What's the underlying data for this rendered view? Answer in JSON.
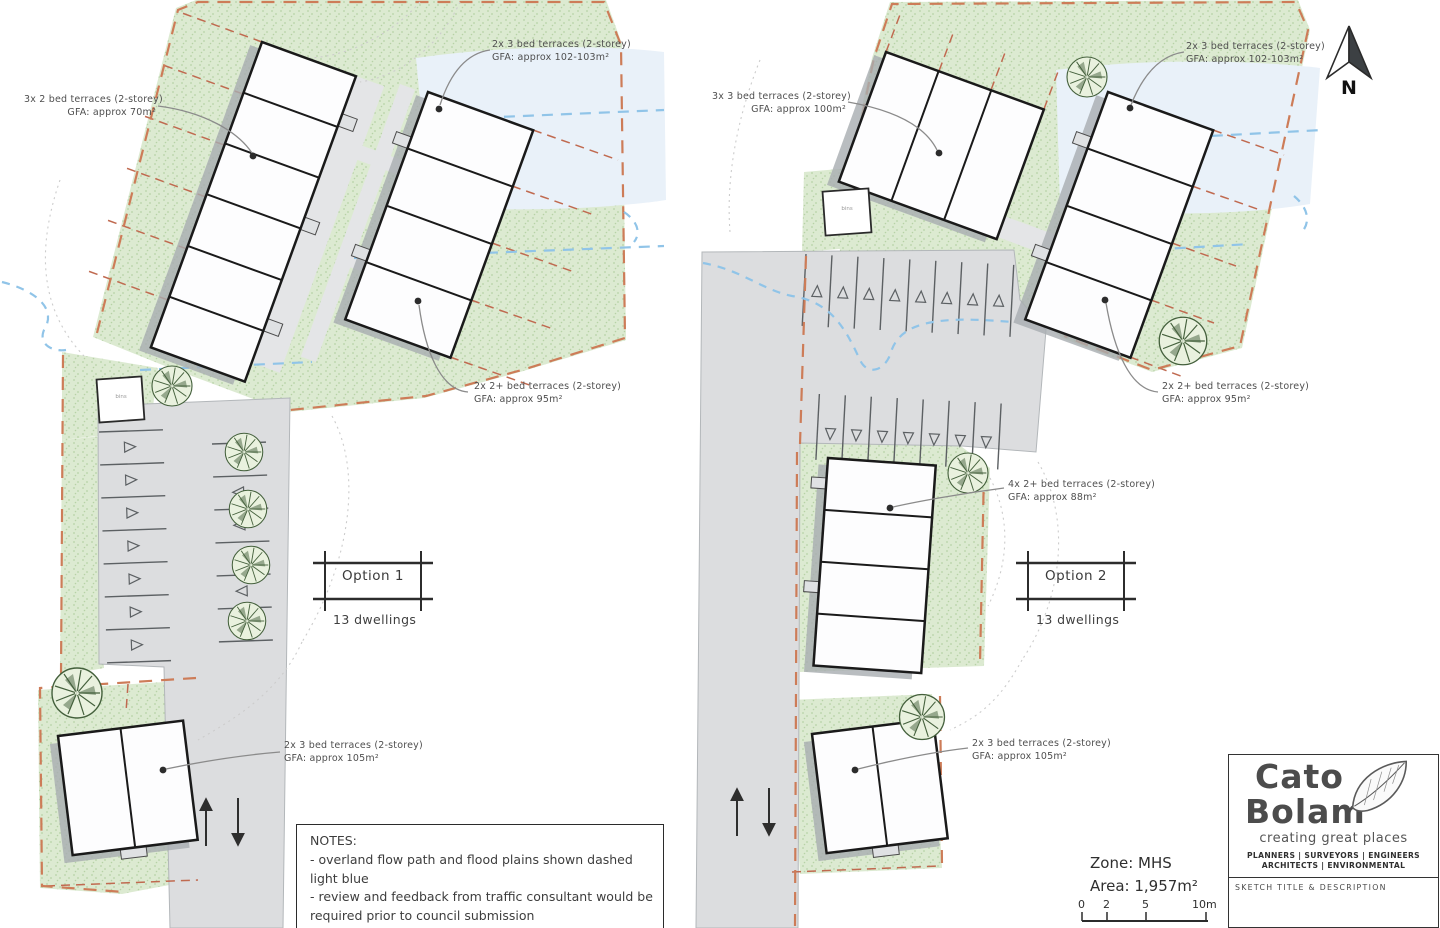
{
  "north_label": "N",
  "plans": {
    "option1": {
      "title": "Option 1",
      "dwellings": "13 dwellings",
      "bin_label": "bins",
      "annotations": [
        {
          "line1": "3x 2 bed terraces  (2-storey)",
          "line2": "GFA: approx 70m²"
        },
        {
          "line1": "2x 3 bed terraces  (2-storey)",
          "line2": "GFA: approx 102-103m²"
        },
        {
          "line1": "2x 2+ bed terraces  (2-storey)",
          "line2": "GFA: approx 95m²"
        },
        {
          "line1": "2x 3 bed terraces  (2-storey)",
          "line2": "GFA: approx 105m²"
        }
      ]
    },
    "option2": {
      "title": "Option 2",
      "dwellings": "13 dwellings",
      "bin_label": "bins",
      "annotations": [
        {
          "line1": "3x 3 bed terraces  (2-storey)",
          "line2": "GFA: approx 100m²"
        },
        {
          "line1": "2x 3 bed terraces  (2-storey)",
          "line2": "GFA: approx 102-103m²"
        },
        {
          "line1": "2x 2+ bed terraces  (2-storey)",
          "line2": "GFA: approx 95m²"
        },
        {
          "line1": "4x 2+ bed terraces  (2-storey)",
          "line2": "GFA: approx 88m²"
        },
        {
          "line1": "2x 3 bed terraces  (2-storey)",
          "line2": "GFA: approx 105m²"
        }
      ]
    }
  },
  "notes": {
    "title": "NOTES:",
    "lines": [
      "- overland flow path and flood plains shown dashed",
      "light blue",
      "- review and feedback from traffic consultant would be",
      "required prior to council submission"
    ]
  },
  "site_info": {
    "zone": "Zone: MHS",
    "area": "Area: 1,957m²"
  },
  "scale_bar": {
    "ticks": [
      "0",
      "2",
      "5",
      "10m"
    ]
  },
  "title_block": {
    "brand_line1": "Cato",
    "brand_line2": "Bolam",
    "tagline": "creating great places",
    "services_line1": "PLANNERS | SURVEYORS | ENGINEERS",
    "services_line2": "ARCHITECTS | ENVIRONMENTAL",
    "sketch_label": "SKETCH TITLE & DESCRIPTION"
  },
  "colors": {
    "landscape_green": "#dcead1",
    "boundary_orange": "#cd7c58",
    "flood_blue": "#90c4e8",
    "road_grey": "#dcdddf",
    "building_outline": "#1a1a1a"
  }
}
